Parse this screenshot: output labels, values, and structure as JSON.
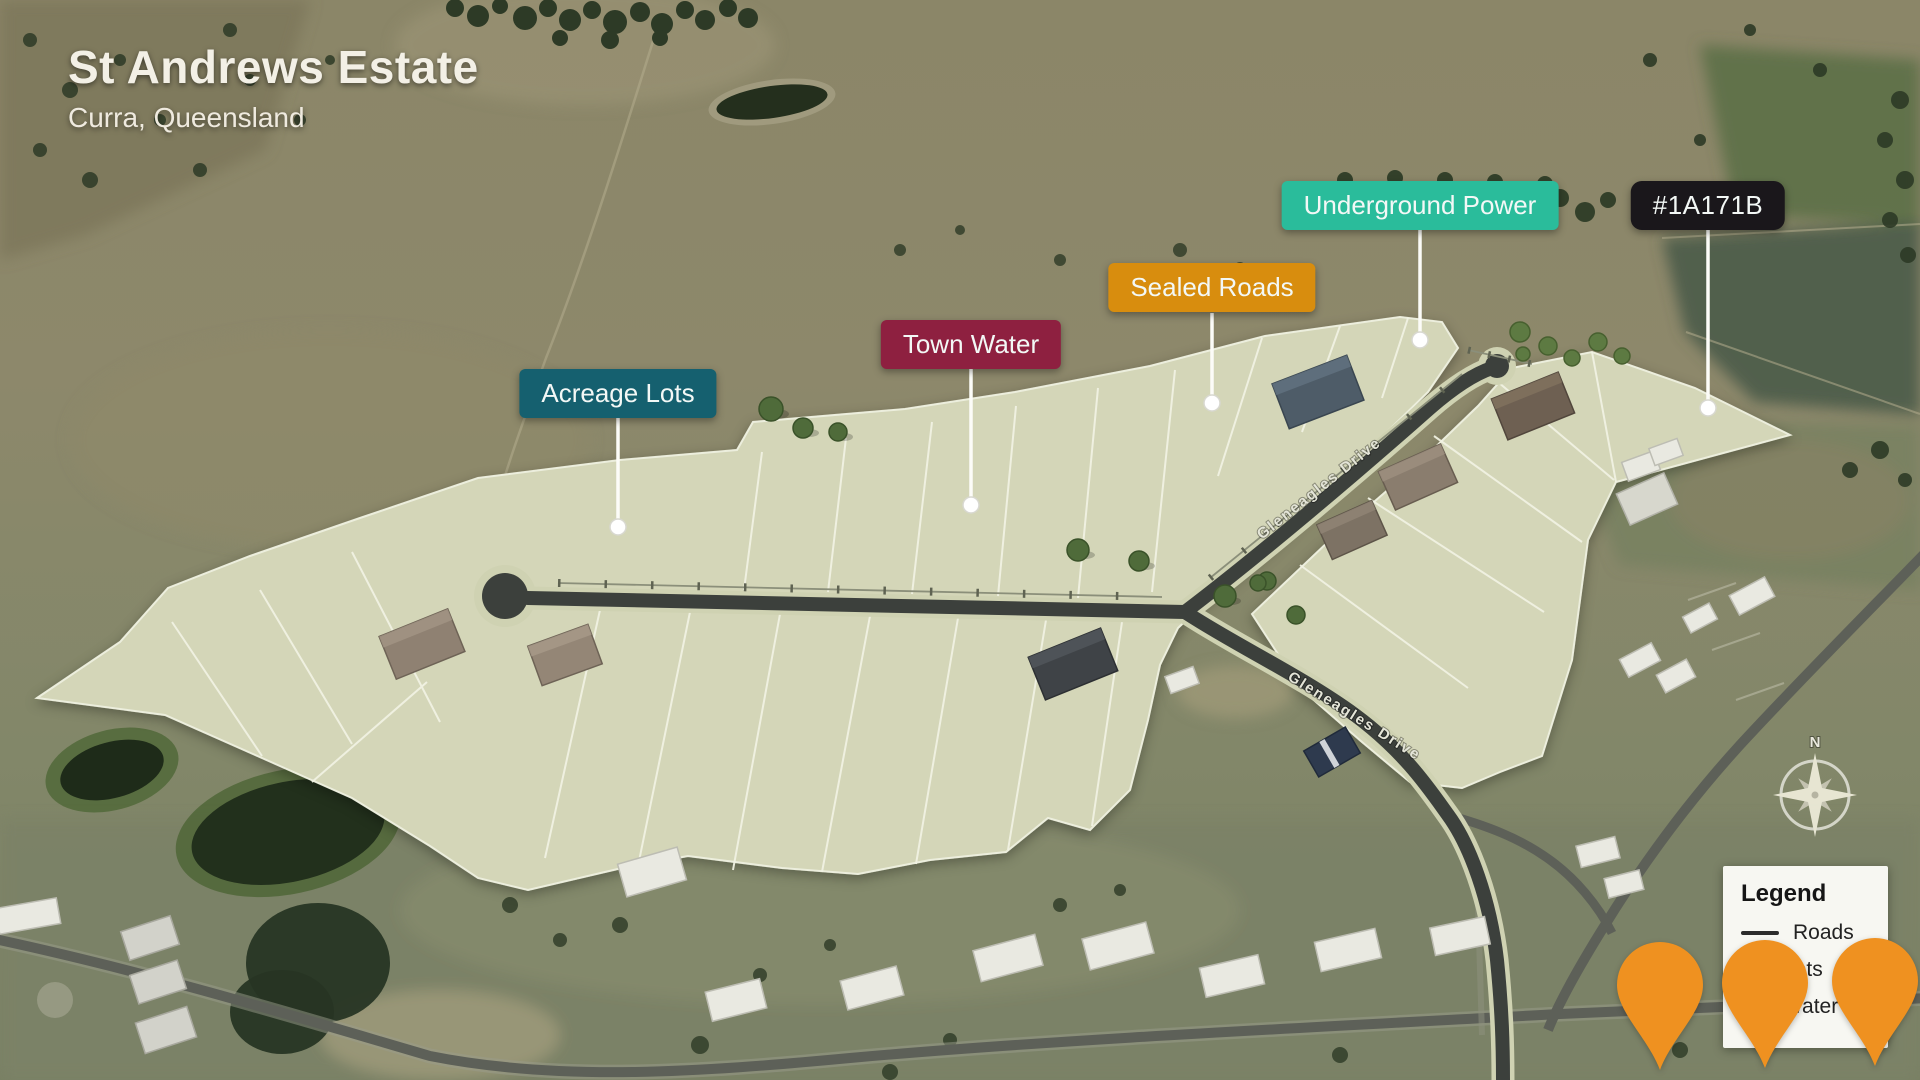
{
  "header": {
    "title": "St Andrews Estate",
    "subtitle": "Curra, Queensland"
  },
  "callouts": [
    {
      "id": "acreage-lots",
      "label": "Acreage Lots",
      "color": "#15606F"
    },
    {
      "id": "town-water",
      "label": "Town Water",
      "color": "#8E2040"
    },
    {
      "id": "sealed-roads",
      "label": "Sealed Roads",
      "color": "#D88D0E"
    },
    {
      "id": "underground-power",
      "label": "Underground Power",
      "color": "#2ABC9B"
    },
    {
      "id": "lot-id",
      "label": "#1A171B",
      "color": "#1A171B"
    }
  ],
  "map": {
    "road_name": "Gleneagles Drive",
    "compass_north_label": "N",
    "estate_lot_color": "#d4d6b8",
    "new_road_color": "#3c403c"
  },
  "legend": {
    "title": "Legend",
    "items": [
      {
        "label": "Roads",
        "swatch": "line"
      },
      {
        "label": "Lots",
        "swatch": "area"
      },
      {
        "label": "Water",
        "swatch": "area"
      }
    ]
  },
  "pins": {
    "color": "#EF9120",
    "count": 3
  }
}
